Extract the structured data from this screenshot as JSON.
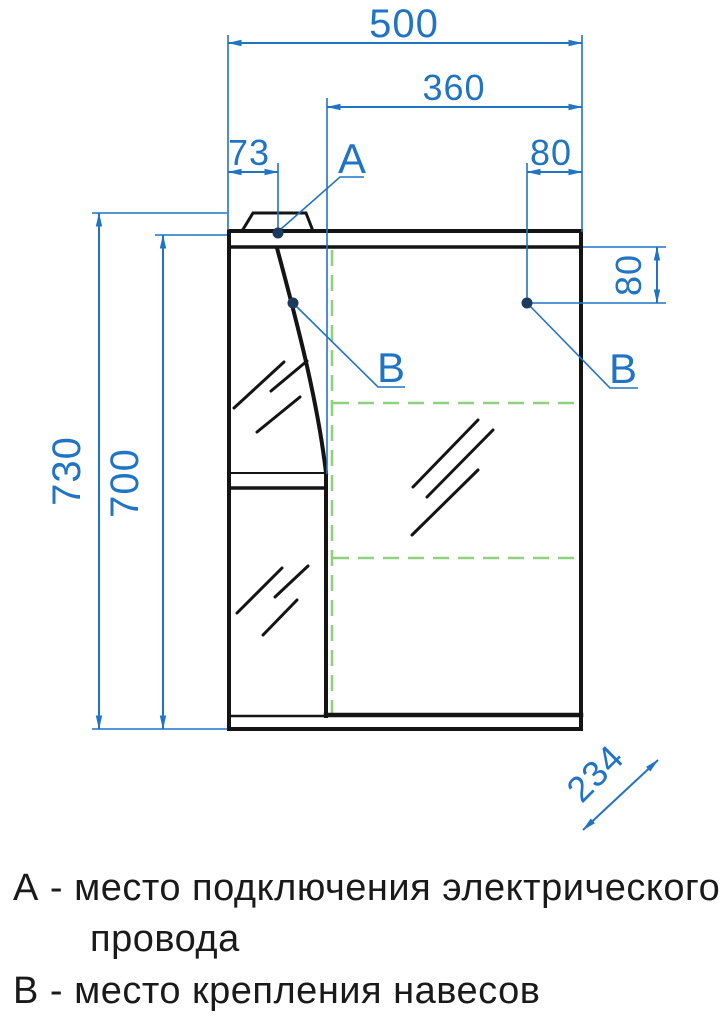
{
  "drawing": {
    "type": "technical-drawing",
    "subject": "mirror-cabinet-front-view",
    "colors": {
      "dimension_blue": "#1f74c4",
      "guide_green": "#8fd17f",
      "outline_black": "#141414",
      "point_dot_navy": "#1b3a5e"
    },
    "dimensions": {
      "overall_width": "500",
      "right_door_width": "360",
      "lamp_offset": "73",
      "hinge_inset_top": "80",
      "overall_height": "730",
      "body_height": "700",
      "hinge_inset_side": "80",
      "depth": "234"
    },
    "markers": {
      "point_a": "А",
      "point_b_left": "В",
      "point_b_right": "В"
    },
    "legend": {
      "line1": "А - место подключения электрического",
      "line2": "провода",
      "line3": "В - место крепления навесов"
    }
  }
}
